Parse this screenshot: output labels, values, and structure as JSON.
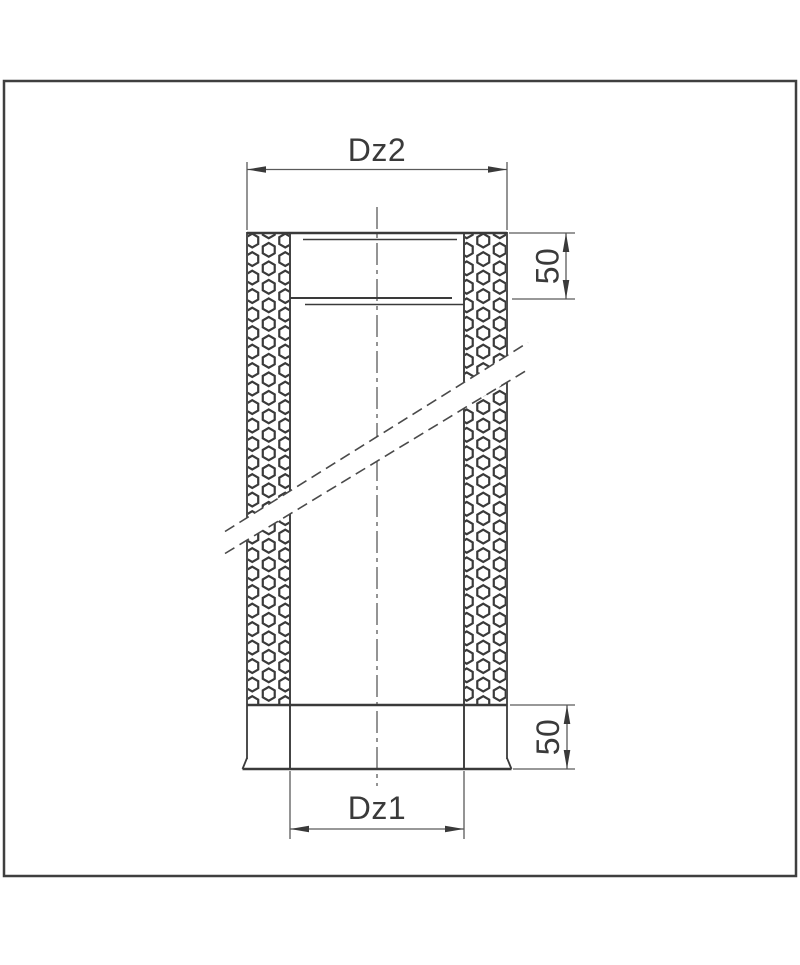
{
  "drawing": {
    "dimension_labels": {
      "outer_diameter": "Dz2",
      "inner_diameter": "Dz1",
      "socket_depth_top": "50",
      "exposed_end_bottom": "50"
    },
    "colors": {
      "line": "#3a3a3a",
      "dimension_line": "#5a5a5a",
      "frame_border": "#3f3f3f",
      "background": "#ffffff"
    }
  }
}
